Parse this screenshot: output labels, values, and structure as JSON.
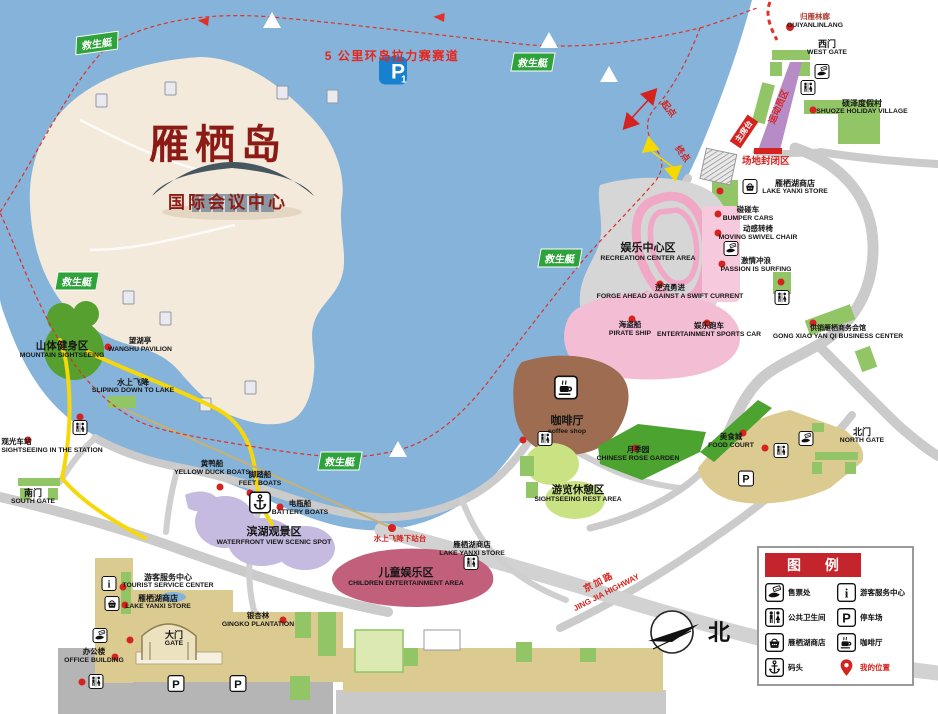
{
  "island": {
    "name": "雁栖岛",
    "subtitle": "国际会议中心",
    "parking_badge": "P",
    "parking_badge_sub": "1"
  },
  "race": {
    "track_label": "5 公里环岛拉力赛赛道",
    "start": "起点",
    "finish": "终点",
    "closed_area": "场地封闭区",
    "athlete_zone": "运动员区",
    "rostrum": "主席台"
  },
  "lifeboat_label": "救生艇",
  "compass_north": "北",
  "highway": {
    "zh": "京加路",
    "en": "JING JIA HIGHWAY"
  },
  "places": {
    "guiyanlinlang": {
      "zh": "归雁林廊",
      "en": "GUIYANLINLANG"
    },
    "west_gate": {
      "zh": "西门",
      "en": "WEST GATE"
    },
    "shuoze_village": {
      "zh": "硕泽度假村",
      "en": "SHUOZE HOLIDAY VILLAGE"
    },
    "lake_store_north": {
      "zh": "雁栖湖商店",
      "en": "LAKE YANXI STORE"
    },
    "bumper_cars": {
      "zh": "碰碰车",
      "en": "BUMPER CARS"
    },
    "swivel_chair": {
      "zh": "动感转椅",
      "en": "MOVING SWIVEL CHAIR"
    },
    "surfing": {
      "zh": "激情冲浪",
      "en": "PASSION IS SURFING"
    },
    "recreation_center": {
      "zh": "娱乐中心区",
      "en": "RECREATION CENTER AREA"
    },
    "forge_ahead": {
      "zh": "逆流勇进",
      "en": "FORGE AHEAD AGAINST A SWIFT CURRENT"
    },
    "pirate_ship": {
      "zh": "海盗船",
      "en": "PIRATE SHIP"
    },
    "sports_car": {
      "zh": "娱乐跑车",
      "en": "ENTERTAINMENT SPORTS CAR"
    },
    "business_center": {
      "zh": "供销雁栖商务会馆",
      "en": "GONG XIAO YAN QI BUSINESS CENTER"
    },
    "coffee_shop": {
      "zh": "咖啡厅",
      "en": "coffee shop"
    },
    "rose_garden": {
      "zh": "月季园",
      "en": "CHINESE ROSE GARDEN"
    },
    "food_court": {
      "zh": "美食城",
      "en": "FOOD COURT"
    },
    "north_gate": {
      "zh": "北门",
      "en": "NORTH GATE"
    },
    "rest_area": {
      "zh": "游览休憩区",
      "en": "SIGHTSEEING REST AREA"
    },
    "children_area": {
      "zh": "儿童娱乐区",
      "en": "CHILDREN ENTERTAINMENT AREA"
    },
    "lake_store_mid": {
      "zh": "雁栖湖商店",
      "en": "LAKE YANXI STORE"
    },
    "waterfront": {
      "zh": "滨湖观景区",
      "en": "WATERFRONT VIEW SCENIC SPOT"
    },
    "battery_boats": {
      "zh": "电瓶船",
      "en": "BATTERY BOATS"
    },
    "feet_boats": {
      "zh": "脚踏船",
      "en": "FEET BOATS"
    },
    "duck_boats": {
      "zh": "黄鸭船",
      "en": "YELLOW DUCK BOATS"
    },
    "slide_platform": {
      "zh": "水上飞降下站台",
      "en": ""
    },
    "water_slide": {
      "zh": "水上飞降",
      "en": "SLIPING DOWN TO LAKE"
    },
    "wanghu_pavilion": {
      "zh": "望湖亭",
      "en": "WANGHU PAVILION"
    },
    "mountain_area": {
      "zh": "山体健身区",
      "en": "MOUNTAIN SIGHTSEEING"
    },
    "sightseeing_station": {
      "zh": "观光车站",
      "en": "SIGHTSEEING IN THE STATION"
    },
    "south_gate": {
      "zh": "南门",
      "en": "SOUTH GATE"
    },
    "tourist_center": {
      "zh": "游客服务中心",
      "en": "TOURIST SERVICE CENTER"
    },
    "lake_store_south": {
      "zh": "雁栖湖商店",
      "en": "LAKE YANXI STORE"
    },
    "main_gate": {
      "zh": "大门",
      "en": "GATE"
    },
    "gingko": {
      "zh": "银杏林",
      "en": "GINGKO PLANTATION"
    },
    "office": {
      "zh": "办公楼",
      "en": "OFFICE BUILDING"
    }
  },
  "legend": {
    "title": "图 例",
    "items": [
      {
        "icon": "ticket-icon",
        "label": "售票处"
      },
      {
        "icon": "info-icon",
        "label": "游客服务中心"
      },
      {
        "icon": "toilet-icon",
        "label": "公共卫生间"
      },
      {
        "icon": "parking-icon",
        "label": "停车场"
      },
      {
        "icon": "store-icon",
        "label": "雁栖湖商店"
      },
      {
        "icon": "coffee-icon",
        "label": "咖啡厅"
      },
      {
        "icon": "anchor-icon",
        "label": "码头"
      },
      {
        "icon": "location-icon",
        "label": "我的位置"
      }
    ]
  },
  "colors": {
    "lake": "#86B3D9",
    "island": "#F4EADC",
    "road": "#CBCBCB",
    "green": "#92C566",
    "dark_green": "#55A02E",
    "pink": "#F3BDD4",
    "rose": "#C2607C",
    "purple": "#C5BADF",
    "brown": "#9E6C51",
    "tan": "#DCCB90",
    "red": "#D5231F",
    "legend_red": "#C4242B",
    "lifeboat_green": "#2EA33B",
    "title_red": "#8C1A15"
  }
}
